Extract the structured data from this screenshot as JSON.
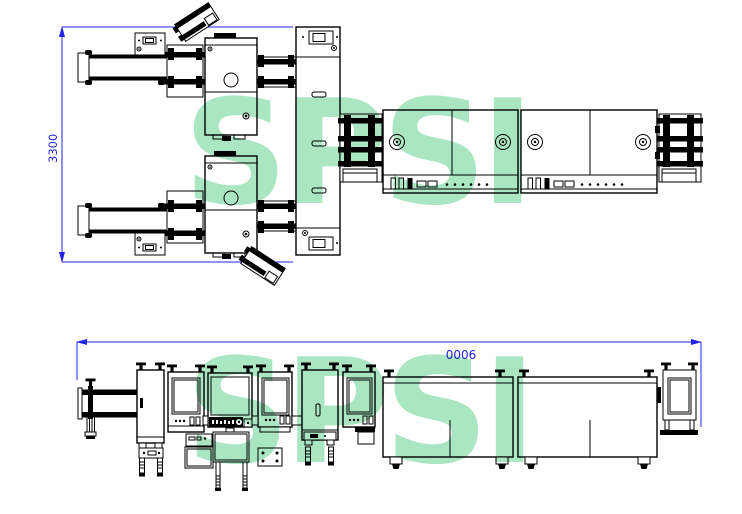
{
  "watermark": {
    "text": "SPSI",
    "color": "#aae6c2"
  },
  "dimensions": {
    "color": "#2323e8",
    "top_view_height_label": "3300",
    "front_view_width_label": "0006"
  }
}
